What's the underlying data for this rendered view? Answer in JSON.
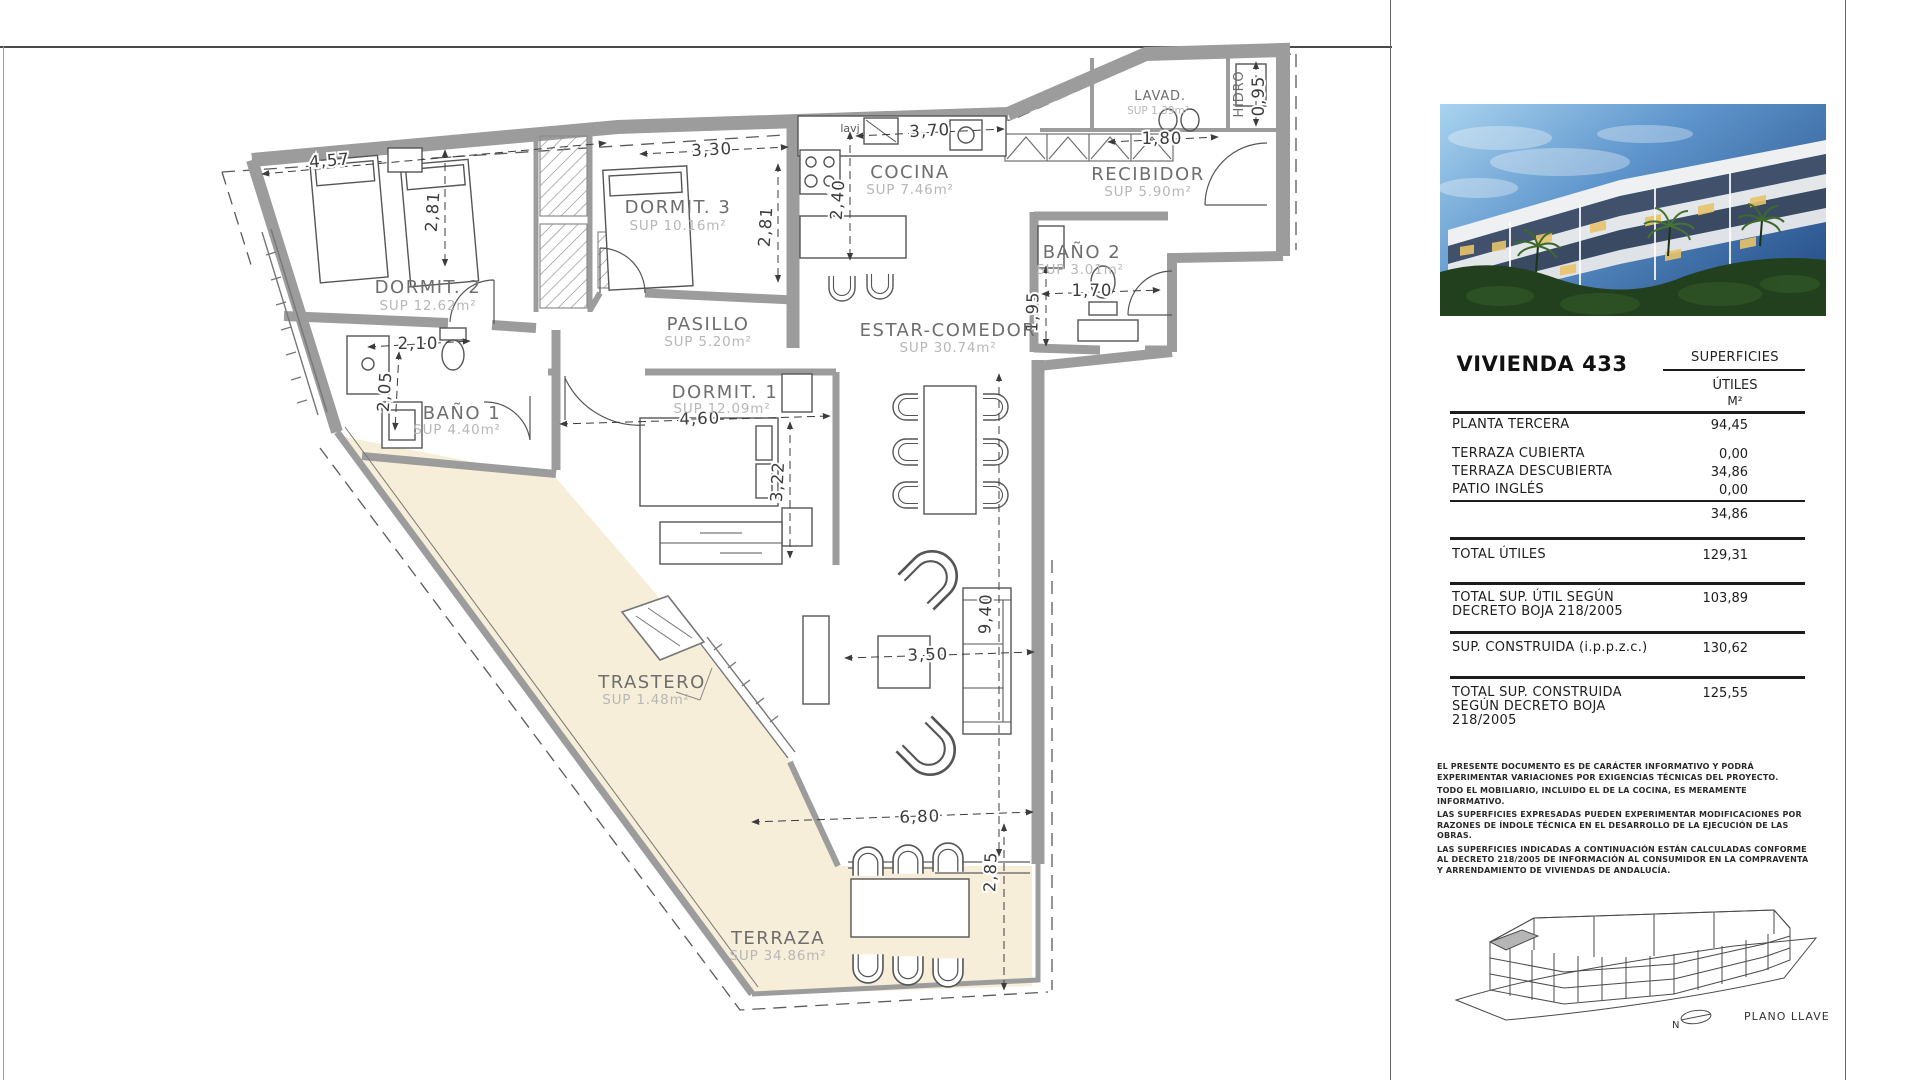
{
  "plan": {
    "rooms": [
      {
        "name": "DORMIT.  2",
        "sup": "SUP  12.62m²"
      },
      {
        "name": "DORMIT.  3",
        "sup": "SUP  10.16m²"
      },
      {
        "name": "COCINA",
        "sup": "SUP  7.46m²"
      },
      {
        "name": "RECIBIDOR",
        "sup": "SUP  5.90m²"
      },
      {
        "name": "LAVAD.",
        "sup": "SUP  1.39m²"
      },
      {
        "name": "HIDRO",
        "sup": ""
      },
      {
        "name": "BAÑO  2",
        "sup": "SUP  3.01m²"
      },
      {
        "name": "PASILLO",
        "sup": "SUP  5.20m²"
      },
      {
        "name": "ESTAR-COMEDOR",
        "sup": "SUP  30.74m²"
      },
      {
        "name": "DORMIT.  1",
        "sup": "SUP  12.09m²"
      },
      {
        "name": "BAÑO  1",
        "sup": "SUP  4.40m²"
      },
      {
        "name": "TRASTERO",
        "sup": "SUP  1.48m²"
      },
      {
        "name": "TERRAZA",
        "sup": "SUP  34.86m²"
      }
    ],
    "dims": [
      "4,57",
      "2,81",
      "3,30",
      "2,81",
      "2,40",
      "3,70",
      "1,80",
      "0,95",
      "1,70",
      "1,95",
      "2,10",
      "2,05",
      "4,60",
      "3,22",
      "3,50",
      "9,40",
      "6,80",
      "2,85"
    ],
    "labels": {
      "lavj": "lavj"
    }
  },
  "panel": {
    "title": "VIVIENDA 433",
    "table": {
      "header": "SUPERFICIES",
      "subheader": "ÚTILES",
      "unit": "M²",
      "rows": [
        {
          "label": "PLANTA TERCERA",
          "value": "94,45"
        },
        {
          "label": "TERRAZA CUBIERTA",
          "value": "0,00"
        },
        {
          "label": "TERRAZA DESCUBIERTA",
          "value": "34,86"
        },
        {
          "label": "PATIO INGLÉS",
          "value": "0,00"
        },
        {
          "label": "",
          "value": "34,86"
        },
        {
          "label": "TOTAL ÚTILES",
          "value": "129,31"
        },
        {
          "label": "TOTAL SUP. ÚTIL SEGÚN DECRETO BOJA 218/2005",
          "value": "103,89"
        },
        {
          "label": "SUP. CONSTRUIDA (i.p.p.z.c.)",
          "value": "130,62"
        },
        {
          "label": "TOTAL SUP. CONSTRUIDA SEGÚN DECRETO BOJA 218/2005",
          "value": "125,55"
        }
      ]
    },
    "disclaimer": [
      "EL PRESENTE DOCUMENTO ES DE CARÁCTER INFORMATIVO Y PODRÁ EXPERIMENTAR VARIACIONES POR EXIGENCIAS TÉCNICAS DEL PROYECTO.",
      "TODO EL MOBILIARIO, INCLUIDO EL DE LA COCINA, ES MERAMENTE INFORMATIVO.",
      "LAS SUPERFICIES EXPRESADAS PUEDEN EXPERIMENTAR MODIFICACIONES POR RAZONES DE ÍNDOLE TÉCNICA EN EL DESARROLLO DE LA EJECUCIÓN DE LAS OBRAS.",
      "LAS SUPERFICIES INDICADAS A CONTINUACIÓN ESTÁN CALCULADAS CONFORME AL DECRETO 218/2005 DE INFORMACIÓN AL CONSUMIDOR EN LA COMPRAVENTA Y ARRENDAMIENTO DE VIVIENDAS DE ANDALUCÍA."
    ],
    "keyplan": {
      "north": "N",
      "label": "PLANO LLAVE"
    }
  }
}
